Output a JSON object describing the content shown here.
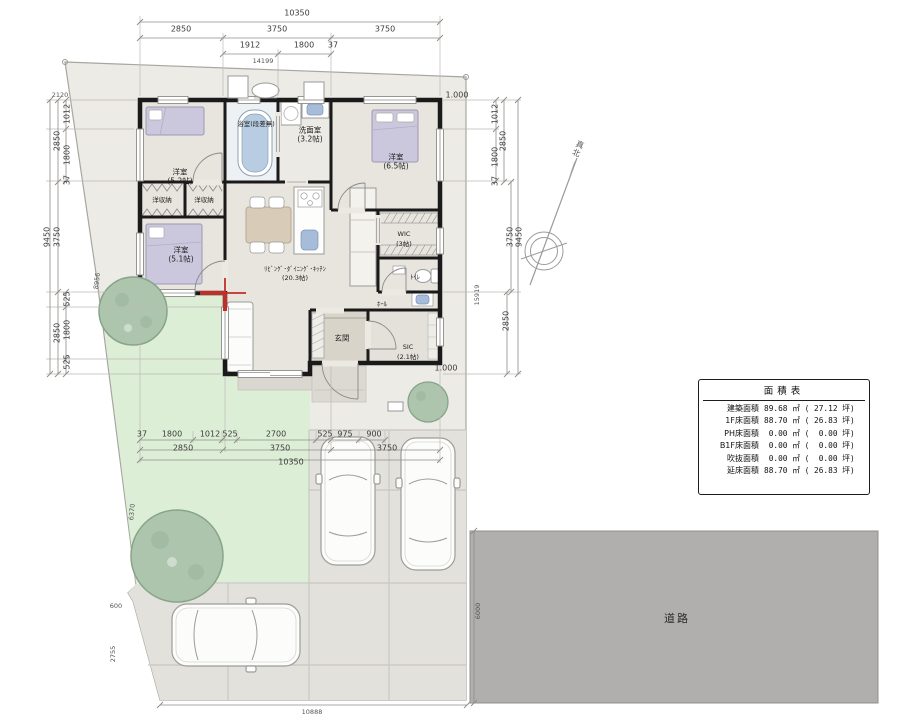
{
  "area_table": {
    "title": "面積表",
    "rows": [
      {
        "label": "建築面積",
        "value": "89.68 ㎡ ( 27.12 坪)"
      },
      {
        "label": "1F床面積",
        "value": "88.70 ㎡ ( 26.83 坪)"
      },
      {
        "label": "PH床面積",
        "value": " 0.00 ㎡ (  0.00 坪)"
      },
      {
        "label": "B1F床面積",
        "value": " 0.00 ㎡ (  0.00 坪)"
      },
      {
        "label": "吹抜面積",
        "value": " 0.00 ㎡ (  0.00 坪)"
      },
      {
        "label": "延床面積",
        "value": "88.70 ㎡ ( 26.83 坪)"
      }
    ]
  },
  "room_labels": [
    {
      "t": "洋室",
      "x": 180,
      "y": 172
    },
    {
      "t": "(5.2帖)",
      "x": 180,
      "y": 181
    },
    {
      "t": "浴室(段差無)",
      "x": 256,
      "y": 123,
      "cls": "small"
    },
    {
      "t": "洗面室",
      "x": 310,
      "y": 130
    },
    {
      "t": "(3.2帖)",
      "x": 310,
      "y": 139
    },
    {
      "t": "洋室",
      "x": 396,
      "y": 157
    },
    {
      "t": "(6.5帖)",
      "x": 396,
      "y": 166
    },
    {
      "t": "洋収納",
      "x": 162,
      "y": 199,
      "cls": "small"
    },
    {
      "t": "洋収納",
      "x": 204,
      "y": 199,
      "cls": "small"
    },
    {
      "t": "洋室",
      "x": 181,
      "y": 250
    },
    {
      "t": "(5.1帖)",
      "x": 181,
      "y": 259
    },
    {
      "t": "ﾘﾋﾞﾝｸﾞ･ﾀﾞｲﾆﾝｸﾞ･ｷｯﾁﾝ",
      "x": 295,
      "y": 268,
      "cls": "small"
    },
    {
      "t": "(20.3帖)",
      "x": 295,
      "y": 277,
      "cls": "small"
    },
    {
      "t": "WIC",
      "x": 404,
      "y": 234,
      "cls": "small"
    },
    {
      "t": "(3帖)",
      "x": 404,
      "y": 243,
      "cls": "small"
    },
    {
      "t": "ﾄｲﾚ",
      "x": 415,
      "y": 276,
      "cls": "small"
    },
    {
      "t": "ﾎｰﾙ",
      "x": 382,
      "y": 303,
      "cls": "small"
    },
    {
      "t": "玄関",
      "x": 342,
      "y": 338
    },
    {
      "t": "SIC",
      "x": 408,
      "y": 347,
      "cls": "small"
    },
    {
      "t": "(2.1帖)",
      "x": 408,
      "y": 356,
      "cls": "small"
    },
    {
      "t": "道路",
      "x": 677,
      "y": 618,
      "n": "road-label",
      "cls": "road"
    },
    {
      "t": "真北",
      "x": 578,
      "y": 149,
      "r": 24,
      "n": "true-north-label",
      "cls": "north"
    }
  ],
  "dimension_labels": [
    {
      "t": "10350",
      "x": 297,
      "y": 13
    },
    {
      "t": "2850",
      "x": 181,
      "y": 29
    },
    {
      "t": "3750",
      "x": 277,
      "y": 29
    },
    {
      "t": "3750",
      "x": 385,
      "y": 29
    },
    {
      "t": "1912",
      "x": 250,
      "y": 45
    },
    {
      "t": "1800",
      "x": 304,
      "y": 45
    },
    {
      "t": "37",
      "x": 333,
      "y": 45
    },
    {
      "t": "14199",
      "x": 263,
      "y": 61,
      "cls": "tiny"
    },
    {
      "t": "2120",
      "x": 60,
      "y": 95,
      "cls": "tiny"
    },
    {
      "t": "1012",
      "x": 67,
      "y": 114,
      "r": -90
    },
    {
      "t": "2850",
      "x": 57,
      "y": 141,
      "r": -90
    },
    {
      "t": "1800",
      "x": 67,
      "y": 155,
      "r": -90
    },
    {
      "t": "37",
      "x": 67,
      "y": 180,
      "r": -90
    },
    {
      "t": "9450",
      "x": 47,
      "y": 237,
      "r": -90
    },
    {
      "t": "3750",
      "x": 57,
      "y": 237,
      "r": -90
    },
    {
      "t": "8956",
      "x": 97,
      "y": 281,
      "r": -83,
      "cls": "tiny"
    },
    {
      "t": "525",
      "x": 67,
      "y": 299,
      "r": -90
    },
    {
      "t": "2850",
      "x": 57,
      "y": 333,
      "r": -90
    },
    {
      "t": "1800",
      "x": 67,
      "y": 330,
      "r": -90
    },
    {
      "t": "525",
      "x": 67,
      "y": 362,
      "r": -90
    },
    {
      "t": "1012",
      "x": 495,
      "y": 114,
      "r": -90
    },
    {
      "t": "2850",
      "x": 503,
      "y": 141,
      "r": -90
    },
    {
      "t": "1800",
      "x": 495,
      "y": 157,
      "r": -90
    },
    {
      "t": "37",
      "x": 495,
      "y": 181,
      "r": -90
    },
    {
      "t": "3750",
      "x": 510,
      "y": 237,
      "r": -90
    },
    {
      "t": "9450",
      "x": 519,
      "y": 237,
      "r": -90
    },
    {
      "t": "15919",
      "x": 477,
      "y": 295,
      "r": -90,
      "cls": "tiny"
    },
    {
      "t": "2850",
      "x": 506,
      "y": 321,
      "r": -90
    },
    {
      "t": "37",
      "x": 142,
      "y": 434
    },
    {
      "t": "1800",
      "x": 172,
      "y": 434
    },
    {
      "t": "1012",
      "x": 210,
      "y": 434
    },
    {
      "t": "525",
      "x": 230,
      "y": 434
    },
    {
      "t": "2700",
      "x": 276,
      "y": 434
    },
    {
      "t": "525",
      "x": 325,
      "y": 434
    },
    {
      "t": "975",
      "x": 345,
      "y": 434
    },
    {
      "t": "900",
      "x": 374,
      "y": 434
    },
    {
      "t": "2850",
      "x": 183,
      "y": 448
    },
    {
      "t": "3750",
      "x": 280,
      "y": 448
    },
    {
      "t": "3750",
      "x": 387,
      "y": 448
    },
    {
      "t": "10350",
      "x": 291,
      "y": 462
    },
    {
      "t": "6370",
      "x": 132,
      "y": 512,
      "r": -85,
      "cls": "tiny"
    },
    {
      "t": "600",
      "x": 116,
      "y": 606,
      "cls": "tiny"
    },
    {
      "t": "2755",
      "x": 113,
      "y": 654,
      "r": -90,
      "cls": "tiny"
    },
    {
      "t": "10888",
      "x": 312,
      "y": 712,
      "cls": "tiny"
    },
    {
      "t": "6000",
      "x": 478,
      "y": 611,
      "r": -90,
      "cls": "tiny"
    },
    {
      "t": "1.000",
      "x": 457,
      "y": 95,
      "n": "offset-label"
    },
    {
      "t": "1.000",
      "x": 446,
      "y": 368,
      "n": "offset-label"
    }
  ]
}
